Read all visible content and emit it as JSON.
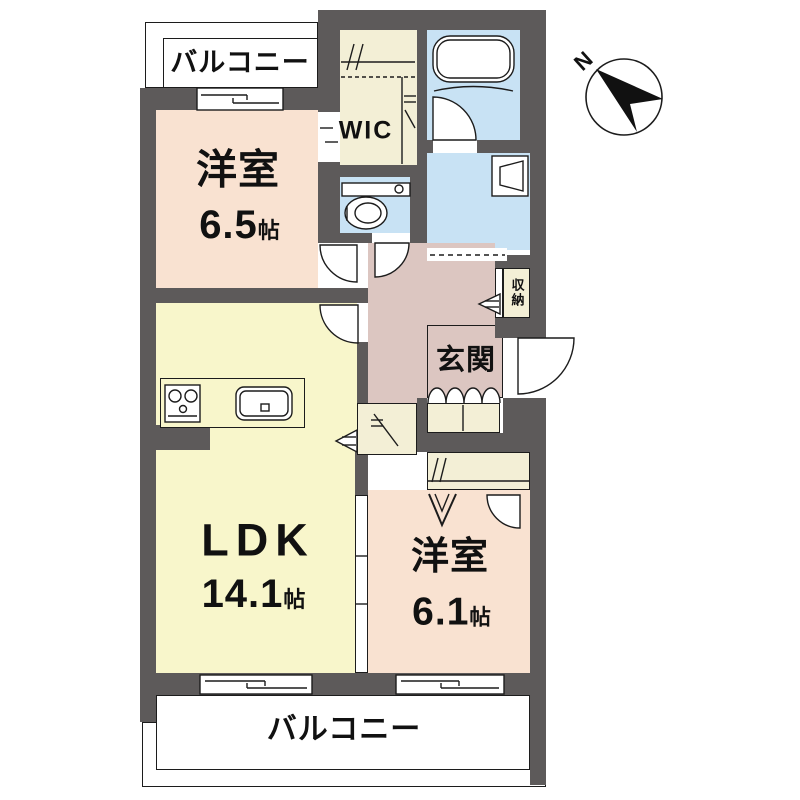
{
  "title": "1LDK+2 apartment floor plan",
  "colors": {
    "bg": "#ffffff",
    "wall": "#5d5a5a",
    "line": "#1c1c1c",
    "ink": "#111111",
    "room_peach": "#f9e2d1",
    "room_yellow": "#f8f6cb",
    "closet_cream": "#f3efd6",
    "water_blue": "#c8e2f4",
    "hall_mauve": "#dcc6c1"
  },
  "rooms": {
    "balcony_top": {
      "label": "バルコニー"
    },
    "bedroom1": {
      "label": "洋室",
      "size_value": "6.5",
      "size_unit": "帖"
    },
    "wic": {
      "label": "WIC"
    },
    "ldk": {
      "label": "LDK",
      "size_value": "14.1",
      "size_unit": "帖"
    },
    "bedroom2": {
      "label": "洋室",
      "size_value": "6.1",
      "size_unit": "帖"
    },
    "genkan": {
      "label": "玄関"
    },
    "storage": {
      "label": "収納"
    },
    "balcony_bottom": {
      "label": "バルコニー"
    }
  },
  "compass": {
    "label": "N"
  },
  "icons": {
    "north-arrow-icon": "black compass needle pointing upper-left inside circle",
    "bathtub-icon": "rounded rectangle tub",
    "toilet-icon": "tank bar with bowl ellipse",
    "washing-machine-icon": "square with trapezoid drum",
    "stove-icon": "two burner circles in box",
    "kitchen-sink-icon": "rounded basin with drain square",
    "door-arc-icon": "quarter-circle swing door",
    "sliding-window-icon": "offset double line sash",
    "folding-door-icon": "double V mark",
    "opening-arrow-icon": "striped triangle arrow"
  }
}
